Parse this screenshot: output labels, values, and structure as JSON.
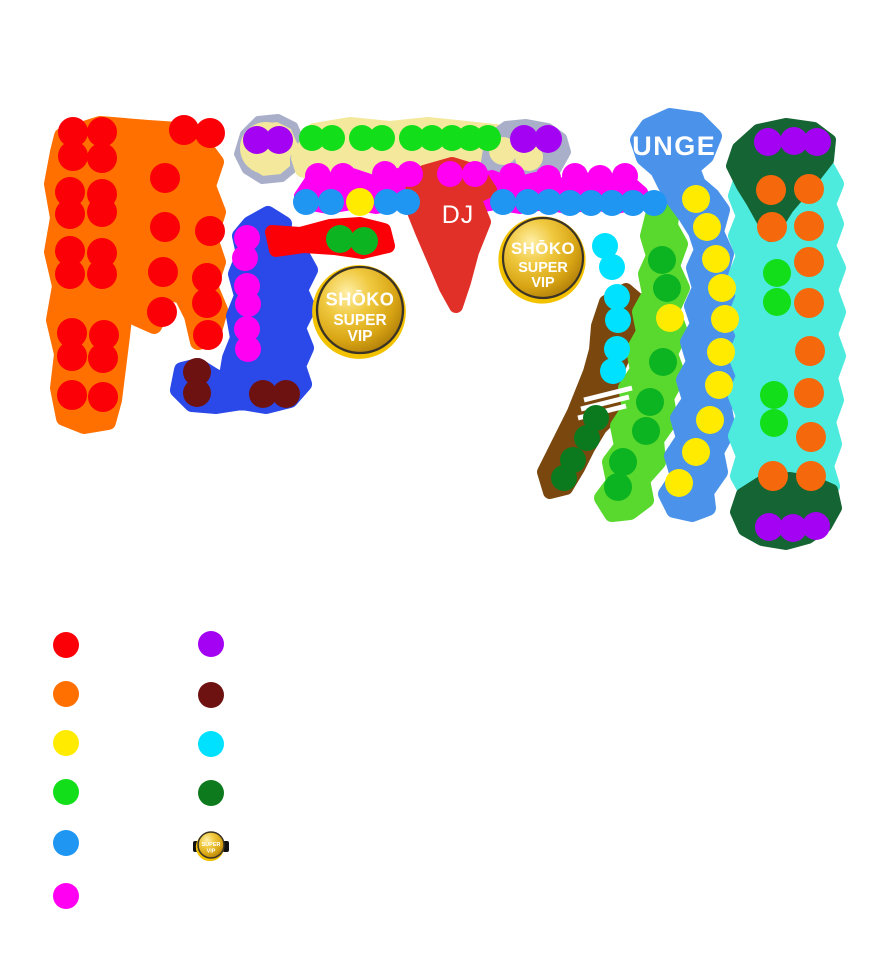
{
  "page": {
    "background": "#FFFFFF"
  },
  "map": {
    "labels": {
      "dj": "DJ",
      "lounge": "LOUNGE"
    },
    "badge": {
      "brand": "SHŌKO",
      "line1": "SUPER",
      "line2": "VIP"
    },
    "colors": {
      "red": "#FB0007",
      "orange_zone": "#FF7000",
      "orange_dot": "#F5690C",
      "yellow": "#FFEB00",
      "green": "#12DE19",
      "mid_green": "#0CB422",
      "bright_green_zone": "#59D82E",
      "blue_dot": "#1E96F2",
      "lounge_blue": "#4B93EA",
      "royal_blue": "#2B49E8",
      "magenta": "#FF00F2",
      "purple": "#A303F2",
      "maroon": "#6E1111",
      "cyan_dot": "#00E1FF",
      "cyan_zone": "#4DEBDD",
      "dark_green_zone": "#156433",
      "dark_green_dot": "#0B7A1E",
      "brown": "#7A480E",
      "khaki": "#F3E89C",
      "silver": "#A9AFC9",
      "dj_red": "#E13028",
      "gold": "#D8A514"
    },
    "zones": [
      {
        "name": "orange-area",
        "fill": "#FF7000",
        "sw": 16,
        "points": "62,136 100,124 148,128 178,130 176,148 204,146 216,162 208,186 218,212 210,238 218,262 210,286 220,310 212,338 198,342 192,316 182,296 168,292 162,312 154,326 136,318 126,300 122,336 118,368 114,400 108,422 84,426 64,418 58,388 62,354 54,320 60,286 52,252 58,218 52,184 58,152"
      },
      {
        "name": "silver-left",
        "fill": "#F3E89C",
        "stroke": "#A9AFC9",
        "sw": 8,
        "points": "244,134 258,120 278,118 294,126 300,140 312,146 316,154 304,162 294,158 294,168 282,178 262,180 246,170 238,154"
      },
      {
        "name": "khaki-band",
        "fill": "#F3E89C",
        "sw": 14,
        "points": "298,158 314,130 350,124 390,128 428,124 466,128 504,132 538,138 554,148 548,164 530,174 500,168 462,176 426,170 390,176 354,172 320,176 302,170"
      },
      {
        "name": "silver-right",
        "fill": "#A9AFC9",
        "sw": 10,
        "points": "490,138 506,126 526,124 548,128 562,138 566,152 556,170 544,186 528,196 510,192 496,180 486,162"
      },
      {
        "name": "magenta-band",
        "fill": "#FF00F2",
        "sw": 12,
        "points": "300,196 312,178 330,184 352,174 376,182 398,174 420,180 446,174 468,180 492,176 512,184 536,178 560,184 584,178 608,184 628,180 642,192 636,204 616,208 592,204 568,208 544,204 520,208 496,204 472,208 448,204 424,208 400,204 376,208 352,204 328,208 306,204"
      },
      {
        "name": "royal-blue-area",
        "fill": "#2B49E8",
        "sw": 16,
        "points": "250,224 268,214 284,224 282,242 300,252 310,270 300,290 308,308 298,328 306,348 298,366 304,384 290,400 266,406 242,402 216,406 192,404 178,390 182,370 198,366 214,376 226,382 230,358 238,338 234,316 242,296 236,274 244,254 240,236"
      },
      {
        "name": "red-arm",
        "fill": "#FB0007",
        "sw": 14,
        "points": "272,232 300,234 330,226 360,224 384,230 388,246 362,252 334,248 304,246 276,250"
      },
      {
        "name": "dj-booth",
        "fill": "#E13028",
        "sw": 14,
        "points": "424,172 452,164 478,172 490,190 474,198 484,222 472,252 464,282 456,306 446,288 434,260 422,232 410,202 414,182"
      },
      {
        "name": "brown-area",
        "fill": "#7A480E",
        "sw": 14,
        "points": "626,290 640,302 636,328 626,350 616,374 626,390 616,412 600,428 588,448 578,468 566,488 550,492 544,472 554,452 564,432 574,412 582,392 590,372 596,350 598,326 606,302"
      },
      {
        "name": "bright-green-area",
        "fill": "#59D82E",
        "sw": 16,
        "points": "654,212 672,206 670,226 680,244 672,266 682,288 672,310 680,332 670,354 678,376 666,398 670,420 656,440 658,462 642,480 646,500 630,512 612,514 602,498 614,482 610,462 622,446 618,426 630,408 626,388 638,370 634,350 644,332 640,312 650,294 646,274 654,256 648,236"
      },
      {
        "name": "lounge-blue-area",
        "fill": "#4B93EA",
        "sw": 16,
        "points": "648,126 670,116 698,120 714,136 706,156 692,168 698,184 712,196 722,210 716,232 726,254 720,276 730,298 724,320 732,342 726,364 734,386 724,408 728,430 716,452 720,472 706,492 708,508 692,514 674,510 666,494 678,476 672,456 684,438 678,418 690,400 684,380 694,362 688,342 698,324 692,306 700,288 694,268 702,250 696,232 686,216 674,200 666,186 658,170 644,158 638,140"
      },
      {
        "name": "cyan-area",
        "fill": "#4DEBDD",
        "sw": 16,
        "points": "744,168 770,158 800,160 826,166 836,184 828,204 836,224 828,246 838,268 830,290 838,312 830,334 838,356 830,378 836,400 828,422 834,444 826,466 832,486 818,498 794,496 770,498 748,494 738,476 744,456 736,436 744,416 736,396 744,376 736,356 744,336 736,316 744,296 736,276 744,256 736,236 744,216 736,196 742,178"
      },
      {
        "name": "dark-green-north",
        "fill": "#156433",
        "sw": 12,
        "points": "738,148 758,130 786,124 814,128 830,140 828,160 814,178 800,194 788,208 778,224 770,236 762,220 752,202 742,186 732,166"
      },
      {
        "name": "dark-green-south",
        "fill": "#156433",
        "sw": 12,
        "points": "742,494 764,480 790,478 814,482 832,490 836,508 826,526 808,538 786,544 762,540 744,530 736,512"
      }
    ],
    "circles": [
      {
        "name": "silver-left-khaki",
        "cx": 266,
        "cy": 148,
        "r": 26,
        "fill": "#F3E89C"
      },
      {
        "name": "silver-right-khaki-1",
        "cx": 503,
        "cy": 151,
        "r": 14,
        "fill": "#F3E89C"
      },
      {
        "name": "silver-right-khaki-2",
        "cx": 529,
        "cy": 157,
        "r": 14,
        "fill": "#F3E89C"
      }
    ],
    "stripes": {
      "color": "#FFFFFF",
      "width": 5,
      "lines": [
        [
          584,
          400,
          632,
          388
        ],
        [
          581,
          409,
          629,
          397
        ],
        [
          578,
          418,
          626,
          406
        ]
      ]
    },
    "dot_groups": [
      {
        "name": "red-tables",
        "color": "#FB0007",
        "r": 15,
        "dots": [
          [
            73,
            132
          ],
          [
            102,
            132
          ],
          [
            184,
            130
          ],
          [
            210,
            133
          ],
          [
            73,
            156
          ],
          [
            102,
            158
          ],
          [
            165,
            178
          ],
          [
            70,
            192
          ],
          [
            102,
            194
          ],
          [
            70,
            214
          ],
          [
            102,
            212
          ],
          [
            165,
            227
          ],
          [
            210,
            231
          ],
          [
            70,
            251
          ],
          [
            102,
            253
          ],
          [
            70,
            274
          ],
          [
            102,
            274
          ],
          [
            163,
            272
          ],
          [
            207,
            278
          ],
          [
            207,
            303
          ],
          [
            162,
            312
          ],
          [
            72,
            333
          ],
          [
            104,
            335
          ],
          [
            208,
            335
          ],
          [
            72,
            356
          ],
          [
            103,
            358
          ],
          [
            72,
            395
          ],
          [
            103,
            397
          ]
        ]
      },
      {
        "name": "green-row-tables",
        "color": "#12DE19",
        "r": 13,
        "dots": [
          [
            312,
            138
          ],
          [
            332,
            138
          ],
          [
            362,
            138
          ],
          [
            382,
            138
          ],
          [
            412,
            138
          ],
          [
            432,
            138
          ],
          [
            452,
            138
          ],
          [
            470,
            138
          ],
          [
            488,
            138
          ]
        ]
      },
      {
        "name": "purple-tables",
        "color": "#A303F2",
        "r": 14,
        "dots": [
          [
            257,
            140
          ],
          [
            279,
            140
          ],
          [
            524,
            139
          ],
          [
            548,
            139
          ],
          [
            768,
            142
          ],
          [
            794,
            141
          ],
          [
            817,
            142
          ],
          [
            769,
            527
          ],
          [
            793,
            528
          ],
          [
            816,
            526
          ]
        ]
      },
      {
        "name": "magenta-tables",
        "color": "#FF00F2",
        "r": 13,
        "dots": [
          [
            318,
            176
          ],
          [
            343,
            176
          ],
          [
            385,
            174
          ],
          [
            410,
            174
          ],
          [
            450,
            174
          ],
          [
            475,
            174
          ],
          [
            512,
            176
          ],
          [
            548,
            178
          ],
          [
            575,
            176
          ],
          [
            600,
            178
          ],
          [
            625,
            176
          ],
          [
            247,
            238
          ],
          [
            245,
            258
          ],
          [
            247,
            286
          ],
          [
            248,
            304
          ],
          [
            247,
            329
          ],
          [
            248,
            349
          ]
        ]
      },
      {
        "name": "blue-row-tables",
        "color": "#1E96F2",
        "r": 13,
        "dots": [
          [
            306,
            202
          ],
          [
            331,
            202
          ],
          [
            387,
            202
          ],
          [
            407,
            202
          ],
          [
            503,
            202
          ],
          [
            528,
            202
          ],
          [
            549,
            202
          ],
          [
            570,
            203
          ],
          [
            591,
            203
          ],
          [
            612,
            203
          ],
          [
            633,
            203
          ],
          [
            654,
            203
          ]
        ]
      },
      {
        "name": "yellow-tables",
        "color": "#FFEB00",
        "r": 14,
        "dots": [
          [
            360,
            202
          ],
          [
            696,
            199
          ],
          [
            707,
            227
          ],
          [
            716,
            259
          ],
          [
            722,
            288
          ],
          [
            725,
            319
          ],
          [
            721,
            352
          ],
          [
            719,
            385
          ],
          [
            710,
            420
          ],
          [
            696,
            452
          ],
          [
            679,
            483
          ],
          [
            670,
            318
          ]
        ]
      },
      {
        "name": "mid-green-tables",
        "color": "#0CB422",
        "r": 14,
        "dots": [
          [
            340,
            239
          ],
          [
            364,
            241
          ],
          [
            662,
            260
          ],
          [
            667,
            288
          ],
          [
            663,
            362
          ],
          [
            650,
            402
          ],
          [
            646,
            431
          ],
          [
            623,
            462
          ],
          [
            618,
            487
          ]
        ]
      },
      {
        "name": "green-pair-tables",
        "color": "#12DE19",
        "r": 14,
        "dots": [
          [
            777,
            273
          ],
          [
            777,
            302
          ],
          [
            774,
            395
          ],
          [
            774,
            423
          ]
        ]
      },
      {
        "name": "maroon-tables",
        "color": "#6E1111",
        "r": 14,
        "dots": [
          [
            197,
            372
          ],
          [
            197,
            393
          ],
          [
            263,
            394
          ],
          [
            286,
            394
          ]
        ]
      },
      {
        "name": "cyan-tables",
        "color": "#00E1FF",
        "r": 13,
        "dots": [
          [
            605,
            246
          ],
          [
            612,
            267
          ],
          [
            617,
            297
          ],
          [
            618,
            320
          ],
          [
            617,
            349
          ],
          [
            613,
            371
          ]
        ]
      },
      {
        "name": "dark-green-tables",
        "color": "#0B7A1E",
        "r": 13,
        "dots": [
          [
            596,
            418
          ],
          [
            587,
            438
          ],
          [
            573,
            460
          ],
          [
            564,
            478
          ]
        ]
      },
      {
        "name": "orange-tables",
        "color": "#F5690C",
        "r": 15,
        "dots": [
          [
            771,
            190
          ],
          [
            809,
            189
          ],
          [
            772,
            227
          ],
          [
            809,
            226
          ],
          [
            809,
            262
          ],
          [
            809,
            303
          ],
          [
            810,
            351
          ],
          [
            809,
            393
          ],
          [
            811,
            437
          ],
          [
            773,
            476
          ],
          [
            811,
            476
          ]
        ]
      }
    ],
    "badges": [
      {
        "x": 360,
        "y": 310,
        "r": 43,
        "show_brand": true,
        "interactable": true
      },
      {
        "x": 543,
        "y": 258,
        "r": 40,
        "show_brand": true,
        "interactable": true
      },
      {
        "x": 211,
        "y": 845,
        "r": 13,
        "show_brand": false,
        "side_marks": true,
        "interactable": false
      }
    ]
  },
  "legend": {
    "swatch_r": 13,
    "items": [
      {
        "name": "red",
        "color": "#FB0007",
        "x": 66,
        "y": 645
      },
      {
        "name": "orange",
        "color": "#FF7000",
        "x": 66,
        "y": 694
      },
      {
        "name": "yellow",
        "color": "#FFEB00",
        "x": 66,
        "y": 743
      },
      {
        "name": "green",
        "color": "#12DE19",
        "x": 66,
        "y": 792
      },
      {
        "name": "blue",
        "color": "#1E96F2",
        "x": 66,
        "y": 843
      },
      {
        "name": "magenta",
        "color": "#FF00F2",
        "x": 66,
        "y": 896
      },
      {
        "name": "purple",
        "color": "#A303F2",
        "x": 211,
        "y": 644
      },
      {
        "name": "dark-red",
        "color": "#6E1111",
        "x": 211,
        "y": 695
      },
      {
        "name": "cyan",
        "color": "#00E1FF",
        "x": 211,
        "y": 744
      },
      {
        "name": "dark-green",
        "color": "#0E7A1E",
        "x": 211,
        "y": 793
      }
    ]
  }
}
